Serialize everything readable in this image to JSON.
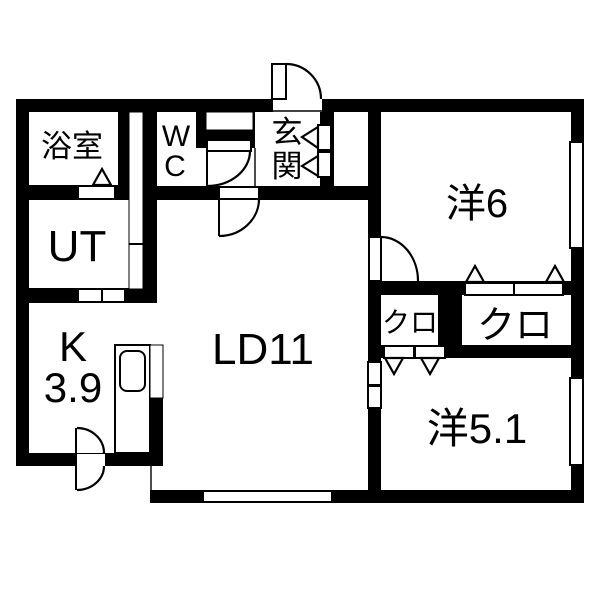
{
  "title": "apartment-floor-plan",
  "colors": {
    "wall": "#000000",
    "background": "#ffffff",
    "line": "#000000"
  },
  "rooms": [
    {
      "id": "bathroom",
      "label": "浴室"
    },
    {
      "id": "wc",
      "label": "WC",
      "line1": "W",
      "line2": "C"
    },
    {
      "id": "utility",
      "label": "UT"
    },
    {
      "id": "kitchen",
      "label": "K 3.9",
      "line1": "K",
      "line2": "3.9"
    },
    {
      "id": "living-dining",
      "label": "LD11"
    },
    {
      "id": "entrance",
      "label": "玄関",
      "line1": "玄",
      "line2": "関"
    },
    {
      "id": "bedroom-6",
      "label": "洋6"
    },
    {
      "id": "closet-small",
      "label": "クロ"
    },
    {
      "id": "closet-large",
      "label": "クロ"
    },
    {
      "id": "bedroom-5-1",
      "label": "洋5.1"
    }
  ]
}
